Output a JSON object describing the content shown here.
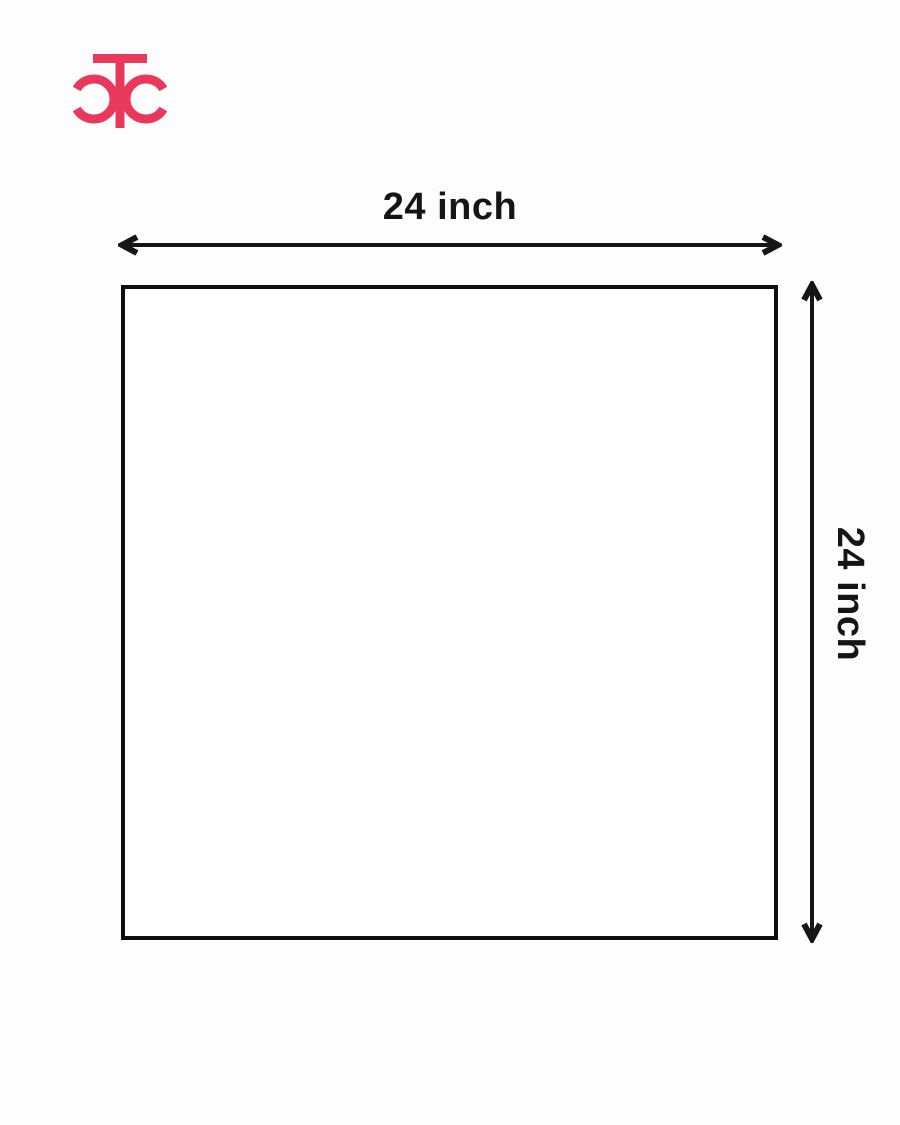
{
  "logo": {
    "monogram": "CTC",
    "color": "#E8395C"
  },
  "diagram": {
    "shape": "square",
    "width_label": "24 inch",
    "height_label": "24 inch",
    "outline_color": "#0E0E0E",
    "fill_color": "#FFFFFF"
  },
  "colors": {
    "accent": "#E8395C",
    "line": "#151515",
    "background": "#FDFDFD"
  }
}
